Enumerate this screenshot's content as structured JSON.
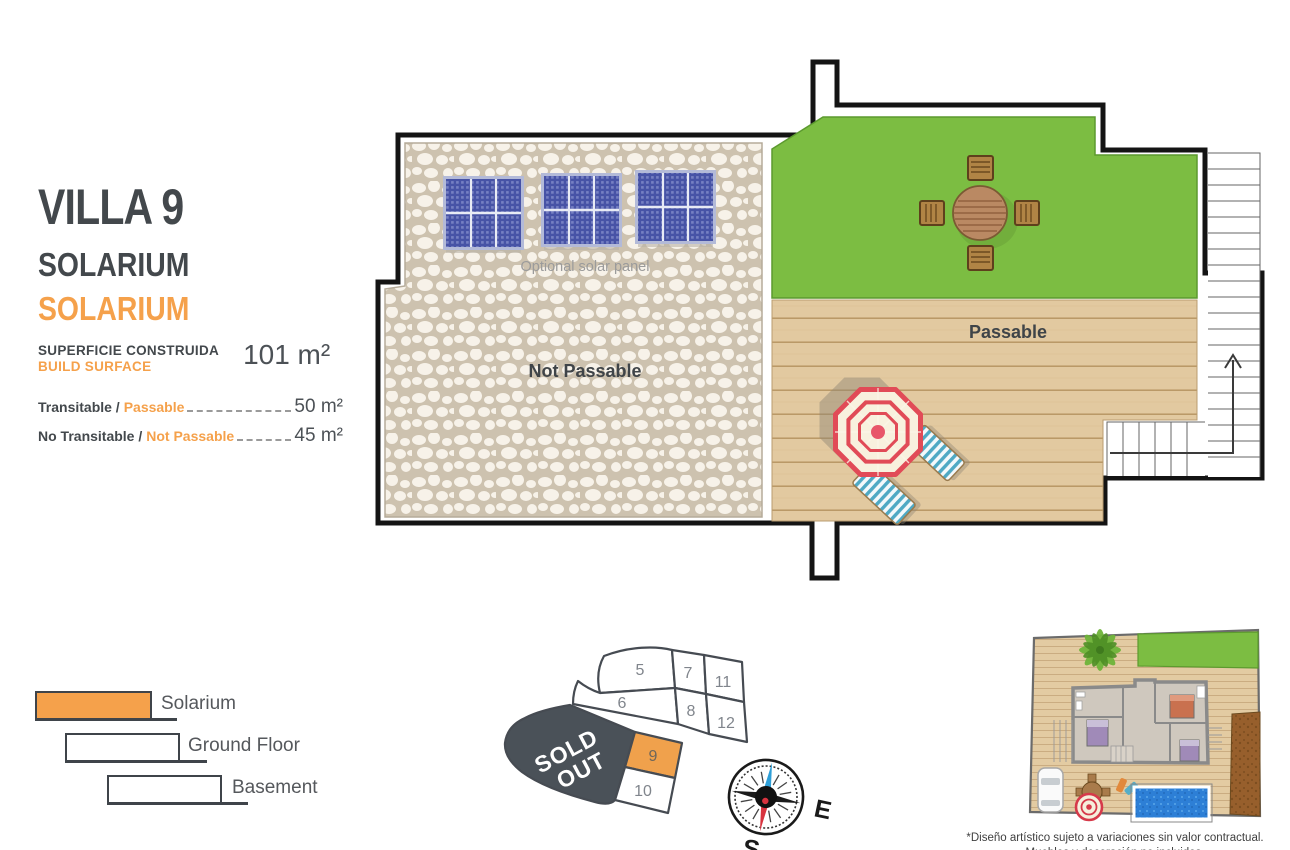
{
  "header": {
    "villa_title": "VILLA 9",
    "subtitle_primary": "SOLARIUM",
    "subtitle_accent": "SOLARIUM"
  },
  "surface": {
    "label_line1": "SUPERFICIE CONSTRUIDA",
    "label_line2": "BUILD SURFACE",
    "value": "101 m²"
  },
  "metrics": [
    {
      "label_a": "Transitable /",
      "label_b": "Passable",
      "value": "50 m²"
    },
    {
      "label_a": "No Transitable /",
      "label_b": "Not Passable",
      "value": "45 m²"
    }
  ],
  "floor_plan": {
    "not_passable_label": "Not Passable",
    "passable_label": "Passable",
    "solar_label": "Optional solar panel"
  },
  "legend": {
    "items": [
      {
        "label": "Solarium"
      },
      {
        "label": "Ground Floor"
      },
      {
        "label": "Basement"
      }
    ]
  },
  "plot_map": {
    "sold_out_line1": "SOLD",
    "sold_out_line2": "OUT",
    "highlighted_plot": "9",
    "plots": {
      "p5": "5",
      "p6": "6",
      "p7": "7",
      "p8": "8",
      "p9": "9",
      "p10": "10",
      "p11": "11",
      "p12": "12"
    }
  },
  "compass": {
    "east_label": "E",
    "south_label": "S"
  },
  "disclaimer": {
    "line1": "*Diseño artístico sujeto a variaciones sin valor contractual.",
    "line2": "Muebles y decoración no incluidos."
  },
  "colors": {
    "accent_orange": "#F5A14B",
    "dark_text": "#43484C",
    "grass_green": "#7CBD42",
    "deck_tan": "#E2C9A0",
    "stone_grout": "#CDC2AF",
    "panel_blue": "#4753A6",
    "sold_out_gray": "#4A5158",
    "umbrella_red": "#E14B57",
    "pool_blue": "#2D7FD6"
  }
}
